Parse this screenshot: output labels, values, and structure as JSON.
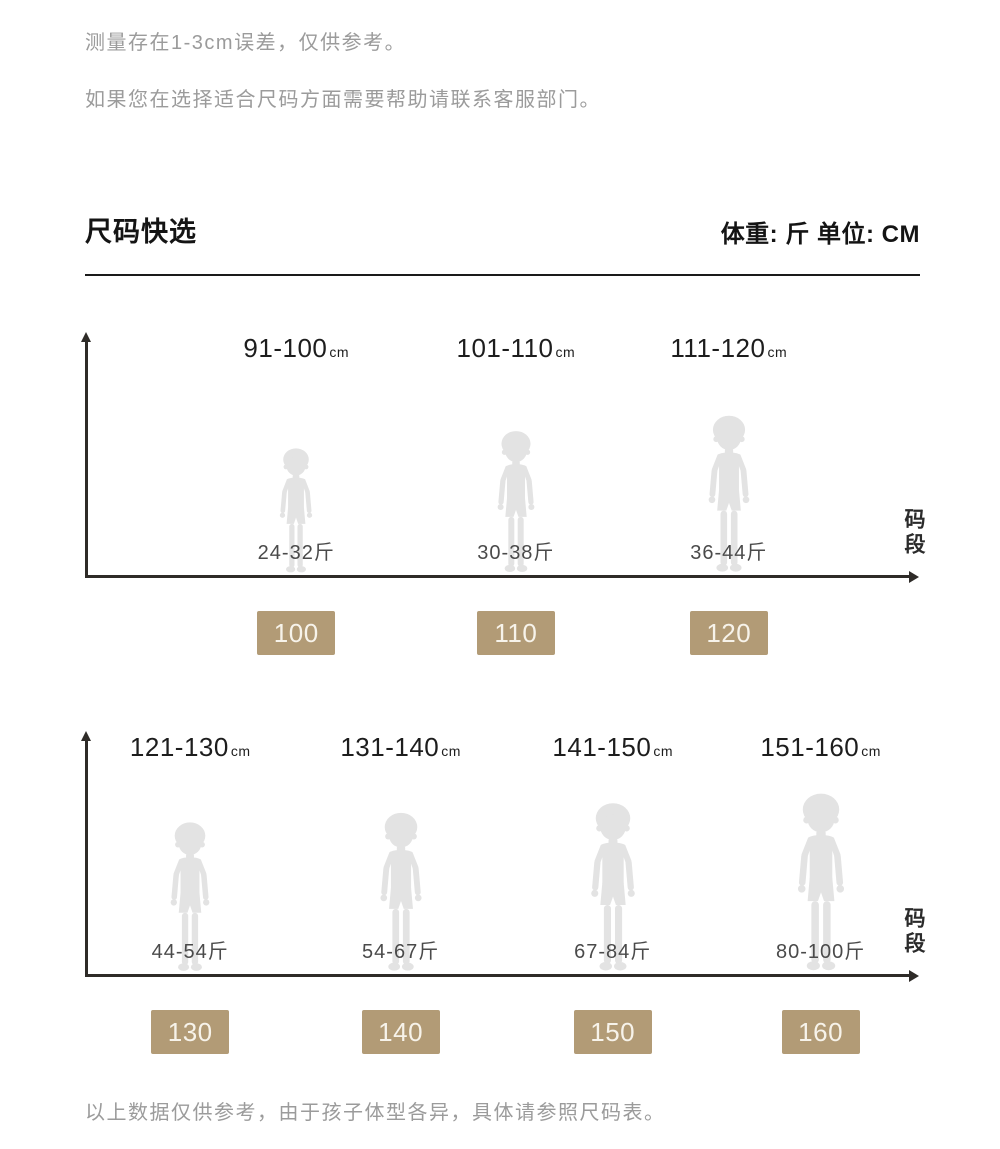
{
  "notes": {
    "measurement": "测量存在1-3cm误差，仅供参考。",
    "service": "如果您在选择适合尺码方面需要帮助请联系客服部门。",
    "footer": "以上数据仅供参考，由于孩子体型各异，具体请参照尺码表。"
  },
  "header": {
    "title": "尺码快选",
    "units": "体重: 斤  单位: CM"
  },
  "colors": {
    "badge": "#b29b76",
    "silhouette": "#e3e3e3",
    "axis": "#2e2b28",
    "note_gray": "#9b9b9b"
  },
  "chart_data": [
    {
      "type": "pictogram",
      "axis": {
        "x_label": "码段",
        "arrow_axes": true
      },
      "groups": [
        {
          "height_range": "91-100",
          "height_unit": "cm",
          "weight_range": "24-32斤",
          "size_code": "100"
        },
        {
          "height_range": "101-110",
          "height_unit": "cm",
          "weight_range": "30-38斤",
          "size_code": "110"
        },
        {
          "height_range": "111-120",
          "height_unit": "cm",
          "weight_range": "36-44斤",
          "size_code": "120"
        }
      ]
    },
    {
      "type": "pictogram",
      "axis": {
        "x_label": "码段",
        "arrow_axes": true
      },
      "groups": [
        {
          "height_range": "121-130",
          "height_unit": "cm",
          "weight_range": "44-54斤",
          "size_code": "130"
        },
        {
          "height_range": "131-140",
          "height_unit": "cm",
          "weight_range": "54-67斤",
          "size_code": "140"
        },
        {
          "height_range": "141-150",
          "height_unit": "cm",
          "weight_range": "67-84斤",
          "size_code": "150"
        },
        {
          "height_range": "151-160",
          "height_unit": "cm",
          "weight_range": "80-100斤",
          "size_code": "160"
        }
      ]
    }
  ]
}
